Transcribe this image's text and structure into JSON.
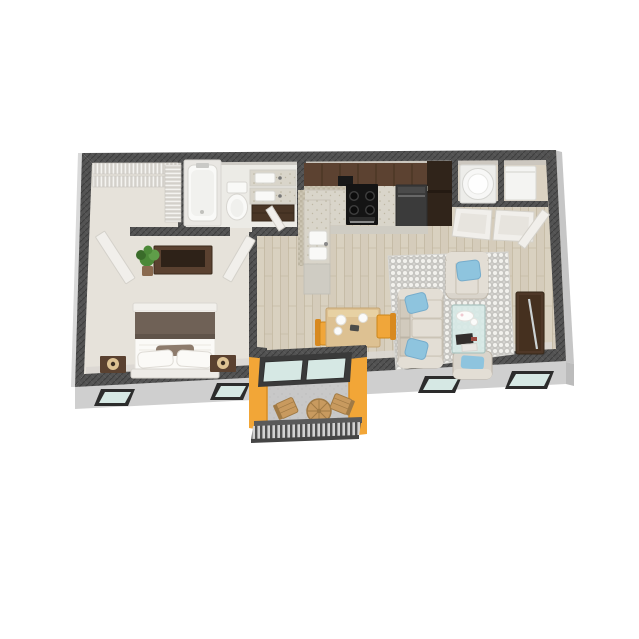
{
  "scene": {
    "type": "3d-floor-plan-render",
    "description": "one-bedroom-one-bath-apartment-with-balcony",
    "background": "#ffffff"
  },
  "colors": {
    "wall_top": "#535353",
    "wall_hatch_dark": "#3d3d3d",
    "wall_hatch_light": "#6f6f6f",
    "wall_inner_top": "#c9c5be",
    "wall_inner_bottom": "#dad7d1",
    "ext_face": "#cfcfcf",
    "ext_side": "#c6c6c6",
    "ext_corner": "#bcbcbc",
    "ext_sliver": "#d9d9d9",
    "window_frame": "#2c2c2c",
    "window_glass": "#d6e8e4",
    "wood_floor": "#d9d1c0",
    "wood_line": "#c2b6a0",
    "wood_lane": "#d1c8b5",
    "carpet": "#e6e2da",
    "tile_floor": "#ecebe6",
    "laundry_floor": "#dbd2c2",
    "balcony_floor": "#c8c8c8",
    "rug_base": "#f2f1ed",
    "rug_pattern": "#c6c5c1",
    "sofa_base": "#d9d4cb",
    "sofa_cushion": "#e3ded5",
    "sofa_shadow": "#beb6a9",
    "back_cushion": "#d1cabd",
    "pillow_blue": "#8ec4de",
    "pillow_blue_edge": "#76accb",
    "glass_table": "#d8eae7",
    "cabinet": "#5c4231",
    "cabinet_dark": "#43301f",
    "counter": "#d9d5ca",
    "counter_dot": "#b2ab94",
    "mosaic_a": "#ccc5b3",
    "mosaic_b": "#bdb5a2",
    "front_face": "#cfccc3",
    "appliance_black": "#141414",
    "appliance_gray": "#3b3b3b",
    "fridge": "#30241a",
    "white_fixture": "#f9f9f7",
    "fixture_edge": "#d8d6d1",
    "vanity_cab": "#4a3626",
    "wood_dark": "#5a4130",
    "tv_dark": "#2e2218",
    "bed_white": "#fbfaf7",
    "blanket": "#6f6156",
    "pillow_tan": "#8d7b6c",
    "lamp_glow": "#f5d9a4",
    "dining_wood": "#ddc192",
    "dining_edge": "#e9d3a6",
    "chair_yellow": "#f0a63a",
    "chair_back": "#d8891f",
    "accent_yellow": "#f2a637",
    "accent_dark": "#d88d22",
    "balcony_wood": "#c89a5f",
    "balcony_wood_dark": "#a07a45",
    "railing": "#4f4f4f",
    "railing_light": "#d2d2d2",
    "door_white": "#f1efeb",
    "door_edge": "#d4d1ca",
    "plant": "#4c8938",
    "plant_dark": "#3a6c2a",
    "plant_light": "#5f9d49",
    "pot": "#8a6a4f",
    "shelf_base": "#d3d0ca",
    "shelf_stripe": "#f4f3f0",
    "steel": "#c9c9c6"
  },
  "rooms": [
    {
      "name": "bedroom",
      "furniture": [
        "bed",
        "nightstand-left",
        "nightstand-right",
        "table-lamp",
        "dresser",
        "flat-tv",
        "potted-plant"
      ]
    },
    {
      "name": "walk-in-closet",
      "furniture": [
        "wire-shelving"
      ]
    },
    {
      "name": "bathroom",
      "furniture": [
        "bathtub",
        "toilet",
        "double-vanity"
      ]
    },
    {
      "name": "hallway",
      "furniture": []
    },
    {
      "name": "kitchen",
      "furniture": [
        "upper-cabinets",
        "range",
        "range-hood",
        "dishwasher",
        "refrigerator",
        "double-sink",
        "granite-counter"
      ]
    },
    {
      "name": "laundry-closet",
      "furniture": [
        "washer",
        "dryer",
        "double-doors"
      ]
    },
    {
      "name": "living-room",
      "furniture": [
        "sofa",
        "armchair",
        "ottoman-chair",
        "coffee-table",
        "area-rug",
        "media-console"
      ]
    },
    {
      "name": "dining-area",
      "furniture": [
        "dining-table",
        "dining-chair-left",
        "dining-chair-right"
      ]
    },
    {
      "name": "balcony",
      "furniture": [
        "patio-chair-left",
        "patio-chair-right",
        "bistro-table",
        "railing",
        "sliding-glass-door"
      ]
    }
  ]
}
